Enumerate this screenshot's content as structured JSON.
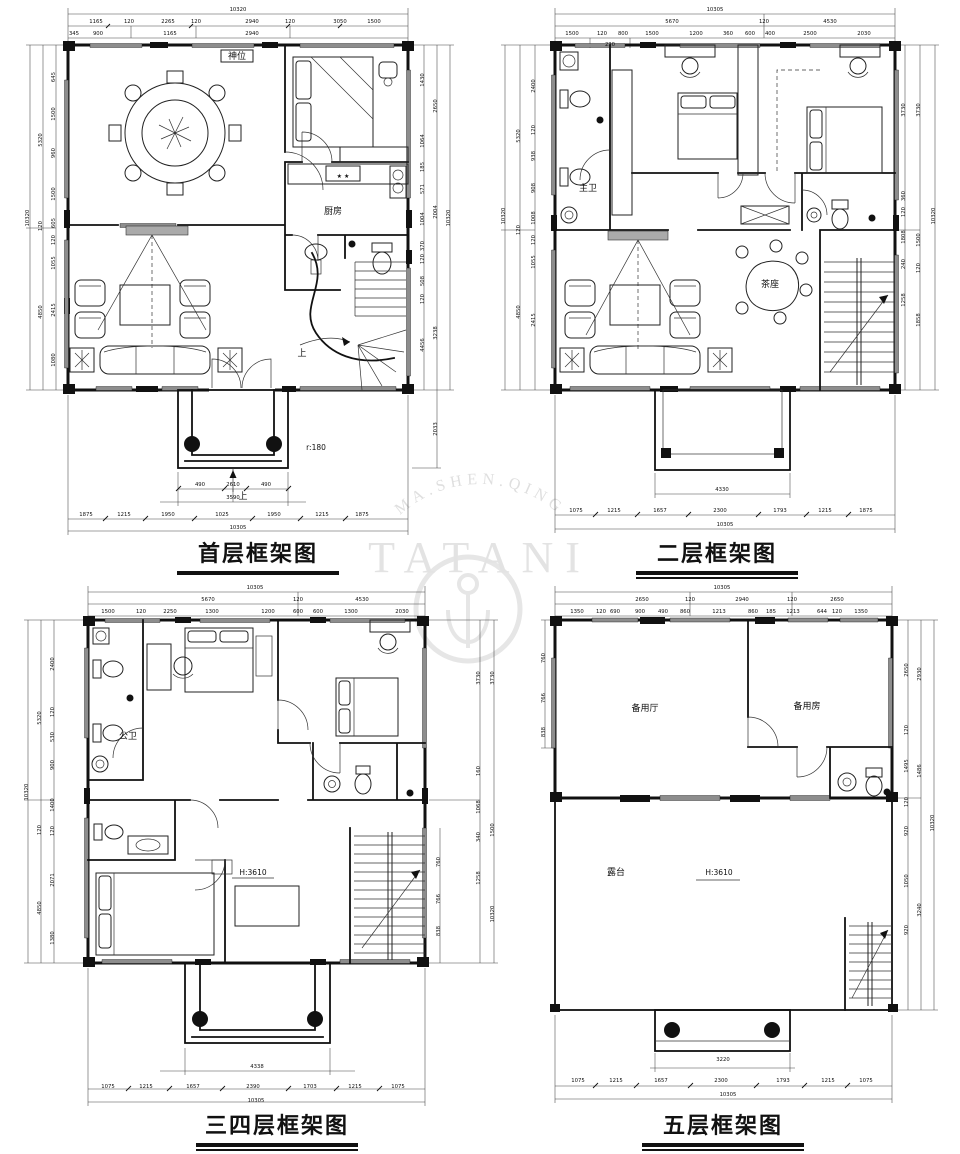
{
  "watermark": {
    "arc": "MA.SHEN.QING",
    "word": "TATANI"
  },
  "plans": [
    {
      "title": "首层框架图",
      "labels": [
        {
          "x": 238,
          "y": 11,
          "t": "10320"
        },
        {
          "x": 96,
          "y": 23,
          "t": "1165"
        },
        {
          "x": 129,
          "y": 23,
          "t": "120"
        },
        {
          "x": 168,
          "y": 23,
          "t": "2265"
        },
        {
          "x": 196,
          "y": 23,
          "t": "120"
        },
        {
          "x": 252,
          "y": 23,
          "t": "2940"
        },
        {
          "x": 290,
          "y": 23,
          "t": "120"
        },
        {
          "x": 340,
          "y": 23,
          "t": "3050"
        },
        {
          "x": 374,
          "y": 23,
          "t": "1500"
        },
        {
          "x": 74,
          "y": 35,
          "t": "345"
        },
        {
          "x": 98,
          "y": 35,
          "t": "900"
        },
        {
          "x": 170,
          "y": 35,
          "t": "1165"
        },
        {
          "x": 252,
          "y": 35,
          "t": "2940"
        },
        {
          "x": 29,
          "y": 218,
          "t": "10320",
          "r": -90
        },
        {
          "x": 42,
          "y": 140,
          "t": "5320",
          "r": -90
        },
        {
          "x": 42,
          "y": 226,
          "t": "120",
          "r": -90
        },
        {
          "x": 42,
          "y": 312,
          "t": "4850",
          "r": -90
        },
        {
          "x": 55,
          "y": 77,
          "t": "645",
          "r": -90
        },
        {
          "x": 55,
          "y": 114,
          "t": "1500",
          "r": -90
        },
        {
          "x": 55,
          "y": 153,
          "t": "960",
          "r": -90
        },
        {
          "x": 55,
          "y": 194,
          "t": "1500",
          "r": -90
        },
        {
          "x": 55,
          "y": 223,
          "t": "605",
          "r": -90
        },
        {
          "x": 55,
          "y": 240,
          "t": "120",
          "r": -90
        },
        {
          "x": 55,
          "y": 263,
          "t": "1055",
          "r": -90
        },
        {
          "x": 55,
          "y": 310,
          "t": "2415",
          "r": -90
        },
        {
          "x": 55,
          "y": 360,
          "t": "1080",
          "r": -90
        },
        {
          "x": 424,
          "y": 80,
          "t": "1430",
          "r": -90
        },
        {
          "x": 424,
          "y": 141,
          "t": "1064",
          "r": -90
        },
        {
          "x": 424,
          "y": 167,
          "t": "185",
          "r": -90
        },
        {
          "x": 424,
          "y": 189,
          "t": "571",
          "r": -90
        },
        {
          "x": 424,
          "y": 219,
          "t": "1004",
          "r": -90
        },
        {
          "x": 424,
          "y": 246,
          "t": "370",
          "r": -90
        },
        {
          "x": 424,
          "y": 259,
          "t": "120",
          "r": -90
        },
        {
          "x": 424,
          "y": 281,
          "t": "508",
          "r": -90
        },
        {
          "x": 424,
          "y": 299,
          "t": "120",
          "r": -90
        },
        {
          "x": 424,
          "y": 345,
          "t": "4456",
          "r": -90
        },
        {
          "x": 437,
          "y": 106,
          "t": "2650",
          "r": -90
        },
        {
          "x": 437,
          "y": 212,
          "t": "2004",
          "r": -90
        },
        {
          "x": 437,
          "y": 333,
          "t": "3238",
          "r": -90
        },
        {
          "x": 450,
          "y": 218,
          "t": "10320",
          "r": -90
        },
        {
          "x": 437,
          "y": 429,
          "t": "2033",
          "r": -90
        },
        {
          "x": 200,
          "y": 486,
          "t": "490"
        },
        {
          "x": 233,
          "y": 486,
          "t": "2610"
        },
        {
          "x": 266,
          "y": 486,
          "t": "490"
        },
        {
          "x": 233,
          "y": 499,
          "t": "3590"
        },
        {
          "x": 86,
          "y": 516,
          "t": "1875"
        },
        {
          "x": 124,
          "y": 516,
          "t": "1215"
        },
        {
          "x": 168,
          "y": 516,
          "t": "1950"
        },
        {
          "x": 222,
          "y": 516,
          "t": "1025"
        },
        {
          "x": 274,
          "y": 516,
          "t": "1950"
        },
        {
          "x": 322,
          "y": 516,
          "t": "1215"
        },
        {
          "x": 362,
          "y": 516,
          "t": "1875"
        },
        {
          "x": 238,
          "y": 529,
          "t": "10305"
        },
        {
          "x": 237,
          "y": 59,
          "t": "神位",
          "c": "room"
        },
        {
          "x": 333,
          "y": 214,
          "t": "厨房",
          "c": "room"
        },
        {
          "x": 343,
          "y": 178,
          "t": "★ ★",
          "c": "tiny"
        },
        {
          "x": 302,
          "y": 356,
          "t": "上",
          "c": "room"
        },
        {
          "x": 316,
          "y": 450,
          "t": "r:180",
          "c": "rmsm"
        },
        {
          "x": 243,
          "y": 499,
          "t": "上",
          "c": "room"
        }
      ]
    },
    {
      "title": "二层框架图",
      "labels": [
        {
          "x": 235,
          "y": 11,
          "t": "10305"
        },
        {
          "x": 192,
          "y": 23,
          "t": "5670"
        },
        {
          "x": 284,
          "y": 23,
          "t": "120"
        },
        {
          "x": 350,
          "y": 23,
          "t": "4530"
        },
        {
          "x": 92,
          "y": 35,
          "t": "1500"
        },
        {
          "x": 122,
          "y": 35,
          "t": "120"
        },
        {
          "x": 143,
          "y": 35,
          "t": "800"
        },
        {
          "x": 172,
          "y": 35,
          "t": "1500"
        },
        {
          "x": 216,
          "y": 35,
          "t": "1200"
        },
        {
          "x": 248,
          "y": 35,
          "t": "360"
        },
        {
          "x": 270,
          "y": 35,
          "t": "600"
        },
        {
          "x": 290,
          "y": 35,
          "t": "400"
        },
        {
          "x": 330,
          "y": 35,
          "t": "2500"
        },
        {
          "x": 384,
          "y": 35,
          "t": "2030"
        },
        {
          "x": 130,
          "y": 46,
          "t": "230"
        },
        {
          "x": 25,
          "y": 216,
          "t": "10320",
          "r": -90
        },
        {
          "x": 40,
          "y": 136,
          "t": "5320",
          "r": -90
        },
        {
          "x": 40,
          "y": 230,
          "t": "120",
          "r": -90
        },
        {
          "x": 40,
          "y": 312,
          "t": "4850",
          "r": -90
        },
        {
          "x": 55,
          "y": 86,
          "t": "2400",
          "r": -90
        },
        {
          "x": 55,
          "y": 130,
          "t": "120",
          "r": -90
        },
        {
          "x": 55,
          "y": 156,
          "t": "938",
          "r": -90
        },
        {
          "x": 55,
          "y": 188,
          "t": "908",
          "r": -90
        },
        {
          "x": 55,
          "y": 218,
          "t": "1008",
          "r": -90
        },
        {
          "x": 55,
          "y": 240,
          "t": "120",
          "r": -90
        },
        {
          "x": 55,
          "y": 262,
          "t": "1055",
          "r": -90
        },
        {
          "x": 55,
          "y": 320,
          "t": "2415",
          "r": -90
        },
        {
          "x": 425,
          "y": 110,
          "t": "3730",
          "r": -90
        },
        {
          "x": 425,
          "y": 196,
          "t": "360",
          "r": -90
        },
        {
          "x": 425,
          "y": 212,
          "t": "120",
          "r": -90
        },
        {
          "x": 425,
          "y": 237,
          "t": "1808",
          "r": -90
        },
        {
          "x": 425,
          "y": 264,
          "t": "240",
          "r": -90
        },
        {
          "x": 425,
          "y": 300,
          "t": "1258",
          "r": -90
        },
        {
          "x": 440,
          "y": 110,
          "t": "3730",
          "r": -90
        },
        {
          "x": 440,
          "y": 240,
          "t": "1500",
          "r": -90
        },
        {
          "x": 440,
          "y": 268,
          "t": "120",
          "r": -90
        },
        {
          "x": 440,
          "y": 320,
          "t": "1858",
          "r": -90
        },
        {
          "x": 455,
          "y": 216,
          "t": "10320",
          "r": -90
        },
        {
          "x": 242,
          "y": 491,
          "t": "4330"
        },
        {
          "x": 96,
          "y": 512,
          "t": "1075"
        },
        {
          "x": 134,
          "y": 512,
          "t": "1215"
        },
        {
          "x": 180,
          "y": 512,
          "t": "1657"
        },
        {
          "x": 240,
          "y": 512,
          "t": "2300"
        },
        {
          "x": 300,
          "y": 512,
          "t": "1793"
        },
        {
          "x": 345,
          "y": 512,
          "t": "1215"
        },
        {
          "x": 386,
          "y": 512,
          "t": "1875"
        },
        {
          "x": 245,
          "y": 526,
          "t": "10305"
        },
        {
          "x": 108,
          "y": 191,
          "t": "主卫",
          "c": "room"
        },
        {
          "x": 290,
          "y": 287,
          "t": "茶座",
          "c": "room"
        }
      ]
    },
    {
      "title": "三四层框架图",
      "labels": [
        {
          "x": 245,
          "y": 11,
          "t": "10305"
        },
        {
          "x": 198,
          "y": 23,
          "t": "5670"
        },
        {
          "x": 288,
          "y": 23,
          "t": "120"
        },
        {
          "x": 352,
          "y": 23,
          "t": "4530"
        },
        {
          "x": 98,
          "y": 35,
          "t": "1500"
        },
        {
          "x": 131,
          "y": 35,
          "t": "120"
        },
        {
          "x": 160,
          "y": 35,
          "t": "2250"
        },
        {
          "x": 202,
          "y": 35,
          "t": "1300"
        },
        {
          "x": 258,
          "y": 35,
          "t": "1200"
        },
        {
          "x": 288,
          "y": 35,
          "t": "600"
        },
        {
          "x": 308,
          "y": 35,
          "t": "600"
        },
        {
          "x": 341,
          "y": 35,
          "t": "1300"
        },
        {
          "x": 392,
          "y": 35,
          "t": "2030"
        },
        {
          "x": 18,
          "y": 214,
          "t": "10320",
          "r": -90
        },
        {
          "x": 31,
          "y": 140,
          "t": "5320",
          "r": -90
        },
        {
          "x": 31,
          "y": 252,
          "t": "120",
          "r": -90
        },
        {
          "x": 31,
          "y": 330,
          "t": "4850",
          "r": -90
        },
        {
          "x": 44,
          "y": 86,
          "t": "2400",
          "r": -90
        },
        {
          "x": 44,
          "y": 134,
          "t": "120",
          "r": -90
        },
        {
          "x": 44,
          "y": 159,
          "t": "530",
          "r": -90
        },
        {
          "x": 44,
          "y": 187,
          "t": "900",
          "r": -90
        },
        {
          "x": 44,
          "y": 227,
          "t": "1400",
          "r": -90
        },
        {
          "x": 44,
          "y": 253,
          "t": "120",
          "r": -90
        },
        {
          "x": 44,
          "y": 302,
          "t": "2071",
          "r": -90
        },
        {
          "x": 44,
          "y": 360,
          "t": "1380",
          "r": -90
        },
        {
          "x": 470,
          "y": 100,
          "t": "3730",
          "r": -90
        },
        {
          "x": 484,
          "y": 100,
          "t": "3730",
          "r": -90
        },
        {
          "x": 470,
          "y": 193,
          "t": "160",
          "r": -90
        },
        {
          "x": 470,
          "y": 229,
          "t": "1068",
          "r": -90
        },
        {
          "x": 470,
          "y": 259,
          "t": "340",
          "r": -90
        },
        {
          "x": 470,
          "y": 300,
          "t": "1258",
          "r": -90
        },
        {
          "x": 484,
          "y": 252,
          "t": "1500",
          "r": -90
        },
        {
          "x": 484,
          "y": 336,
          "t": "10320",
          "r": -90
        },
        {
          "x": 430,
          "y": 284,
          "t": "760",
          "r": -90
        },
        {
          "x": 430,
          "y": 321,
          "t": "766",
          "r": -90
        },
        {
          "x": 430,
          "y": 353,
          "t": "838",
          "r": -90
        },
        {
          "x": 247,
          "y": 490,
          "t": "4338"
        },
        {
          "x": 98,
          "y": 510,
          "t": "1075"
        },
        {
          "x": 136,
          "y": 510,
          "t": "1215"
        },
        {
          "x": 183,
          "y": 510,
          "t": "1657"
        },
        {
          "x": 243,
          "y": 510,
          "t": "2390"
        },
        {
          "x": 300,
          "y": 510,
          "t": "1703"
        },
        {
          "x": 345,
          "y": 510,
          "t": "1215"
        },
        {
          "x": 388,
          "y": 510,
          "t": "1075"
        },
        {
          "x": 246,
          "y": 524,
          "t": "10305"
        },
        {
          "x": 118,
          "y": 161,
          "t": "公卫",
          "c": "room"
        },
        {
          "x": 243,
          "y": 297,
          "t": "H:3610",
          "c": "rmsm"
        }
      ]
    },
    {
      "title": "五层框架图",
      "labels": [
        {
          "x": 222,
          "y": 11,
          "t": "10305"
        },
        {
          "x": 142,
          "y": 23,
          "t": "2650"
        },
        {
          "x": 190,
          "y": 23,
          "t": "120"
        },
        {
          "x": 242,
          "y": 23,
          "t": "2940"
        },
        {
          "x": 292,
          "y": 23,
          "t": "120"
        },
        {
          "x": 337,
          "y": 23,
          "t": "2650"
        },
        {
          "x": 77,
          "y": 35,
          "t": "1350"
        },
        {
          "x": 101,
          "y": 35,
          "t": "120"
        },
        {
          "x": 115,
          "y": 35,
          "t": "690"
        },
        {
          "x": 140,
          "y": 35,
          "t": "900"
        },
        {
          "x": 163,
          "y": 35,
          "t": "490"
        },
        {
          "x": 185,
          "y": 35,
          "t": "860"
        },
        {
          "x": 219,
          "y": 35,
          "t": "1213"
        },
        {
          "x": 253,
          "y": 35,
          "t": "860"
        },
        {
          "x": 271,
          "y": 35,
          "t": "185"
        },
        {
          "x": 293,
          "y": 35,
          "t": "1213"
        },
        {
          "x": 322,
          "y": 35,
          "t": "644"
        },
        {
          "x": 337,
          "y": 35,
          "t": "120"
        },
        {
          "x": 361,
          "y": 35,
          "t": "1350"
        },
        {
          "x": 45,
          "y": 80,
          "t": "760",
          "r": -90
        },
        {
          "x": 45,
          "y": 120,
          "t": "766",
          "r": -90
        },
        {
          "x": 45,
          "y": 154,
          "t": "838",
          "r": -90
        },
        {
          "x": 408,
          "y": 92,
          "t": "2650",
          "r": -90
        },
        {
          "x": 408,
          "y": 152,
          "t": "120",
          "r": -90
        },
        {
          "x": 408,
          "y": 188,
          "t": "1495",
          "r": -90
        },
        {
          "x": 408,
          "y": 224,
          "t": "120",
          "r": -90
        },
        {
          "x": 408,
          "y": 253,
          "t": "920",
          "r": -90
        },
        {
          "x": 408,
          "y": 303,
          "t": "1050",
          "r": -90
        },
        {
          "x": 408,
          "y": 352,
          "t": "920",
          "r": -90
        },
        {
          "x": 421,
          "y": 96,
          "t": "2930",
          "r": -90
        },
        {
          "x": 421,
          "y": 193,
          "t": "1486",
          "r": -90
        },
        {
          "x": 421,
          "y": 332,
          "t": "3240",
          "r": -90
        },
        {
          "x": 434,
          "y": 245,
          "t": "10320",
          "r": -90
        },
        {
          "x": 223,
          "y": 483,
          "t": "3220"
        },
        {
          "x": 78,
          "y": 504,
          "t": "1075"
        },
        {
          "x": 116,
          "y": 504,
          "t": "1215"
        },
        {
          "x": 161,
          "y": 504,
          "t": "1657"
        },
        {
          "x": 221,
          "y": 504,
          "t": "2300"
        },
        {
          "x": 283,
          "y": 504,
          "t": "1793"
        },
        {
          "x": 328,
          "y": 504,
          "t": "1215"
        },
        {
          "x": 366,
          "y": 504,
          "t": "1075"
        },
        {
          "x": 228,
          "y": 518,
          "t": "10305"
        },
        {
          "x": 145,
          "y": 133,
          "t": "备用厅",
          "c": "room"
        },
        {
          "x": 307,
          "y": 131,
          "t": "备用房",
          "c": "room"
        },
        {
          "x": 116,
          "y": 297,
          "t": "露台",
          "c": "room"
        },
        {
          "x": 219,
          "y": 297,
          "t": "H:3610",
          "c": "rmsm"
        }
      ]
    }
  ]
}
